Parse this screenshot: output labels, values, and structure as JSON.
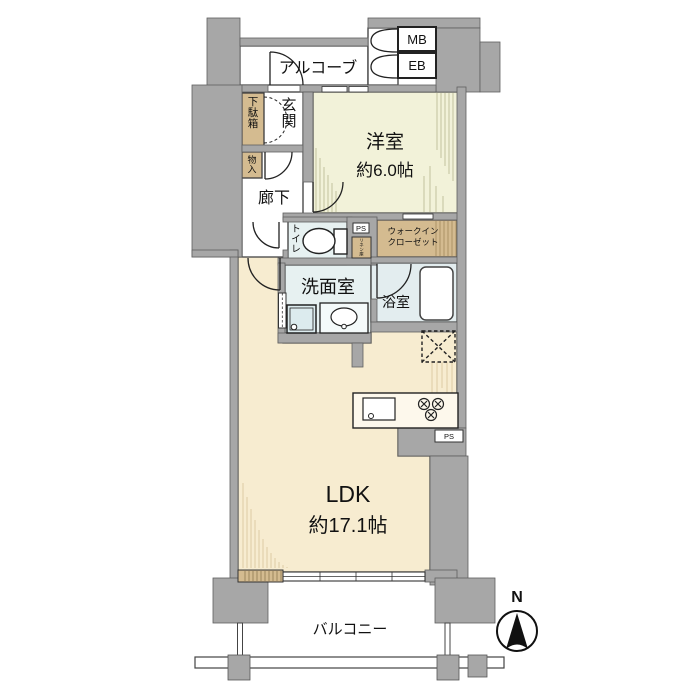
{
  "floor_plan": {
    "alcove": "アルコーブ",
    "mb": "MB",
    "eb": "EB",
    "shoe_cabinet": "下駄箱",
    "entrance": "玄関",
    "storage": "物入",
    "hallway": "廊下",
    "western_room": "洋室",
    "western_room_size": "約6.0帖",
    "toilet": "トイレ",
    "pipe_space_top": "PS",
    "linen": "リネン庫",
    "wic_line1": "ウォークイン",
    "wic_line2": "クローゼット",
    "washroom": "洗面室",
    "bathroom": "浴室",
    "kitchen_pipe_space": "PS",
    "ldk": "LDK",
    "ldk_size": "約17.1帖",
    "balcony": "バルコニー",
    "compass_north": "N"
  },
  "colors": {
    "wall": "#a7a7a7",
    "western_room_floor": "#f2f2d9",
    "ldk_floor": "#f7ecd0",
    "closet": "#d4bb90",
    "wet_area_floor": "#e7f1f1",
    "bath_floor": "#e3edef"
  }
}
